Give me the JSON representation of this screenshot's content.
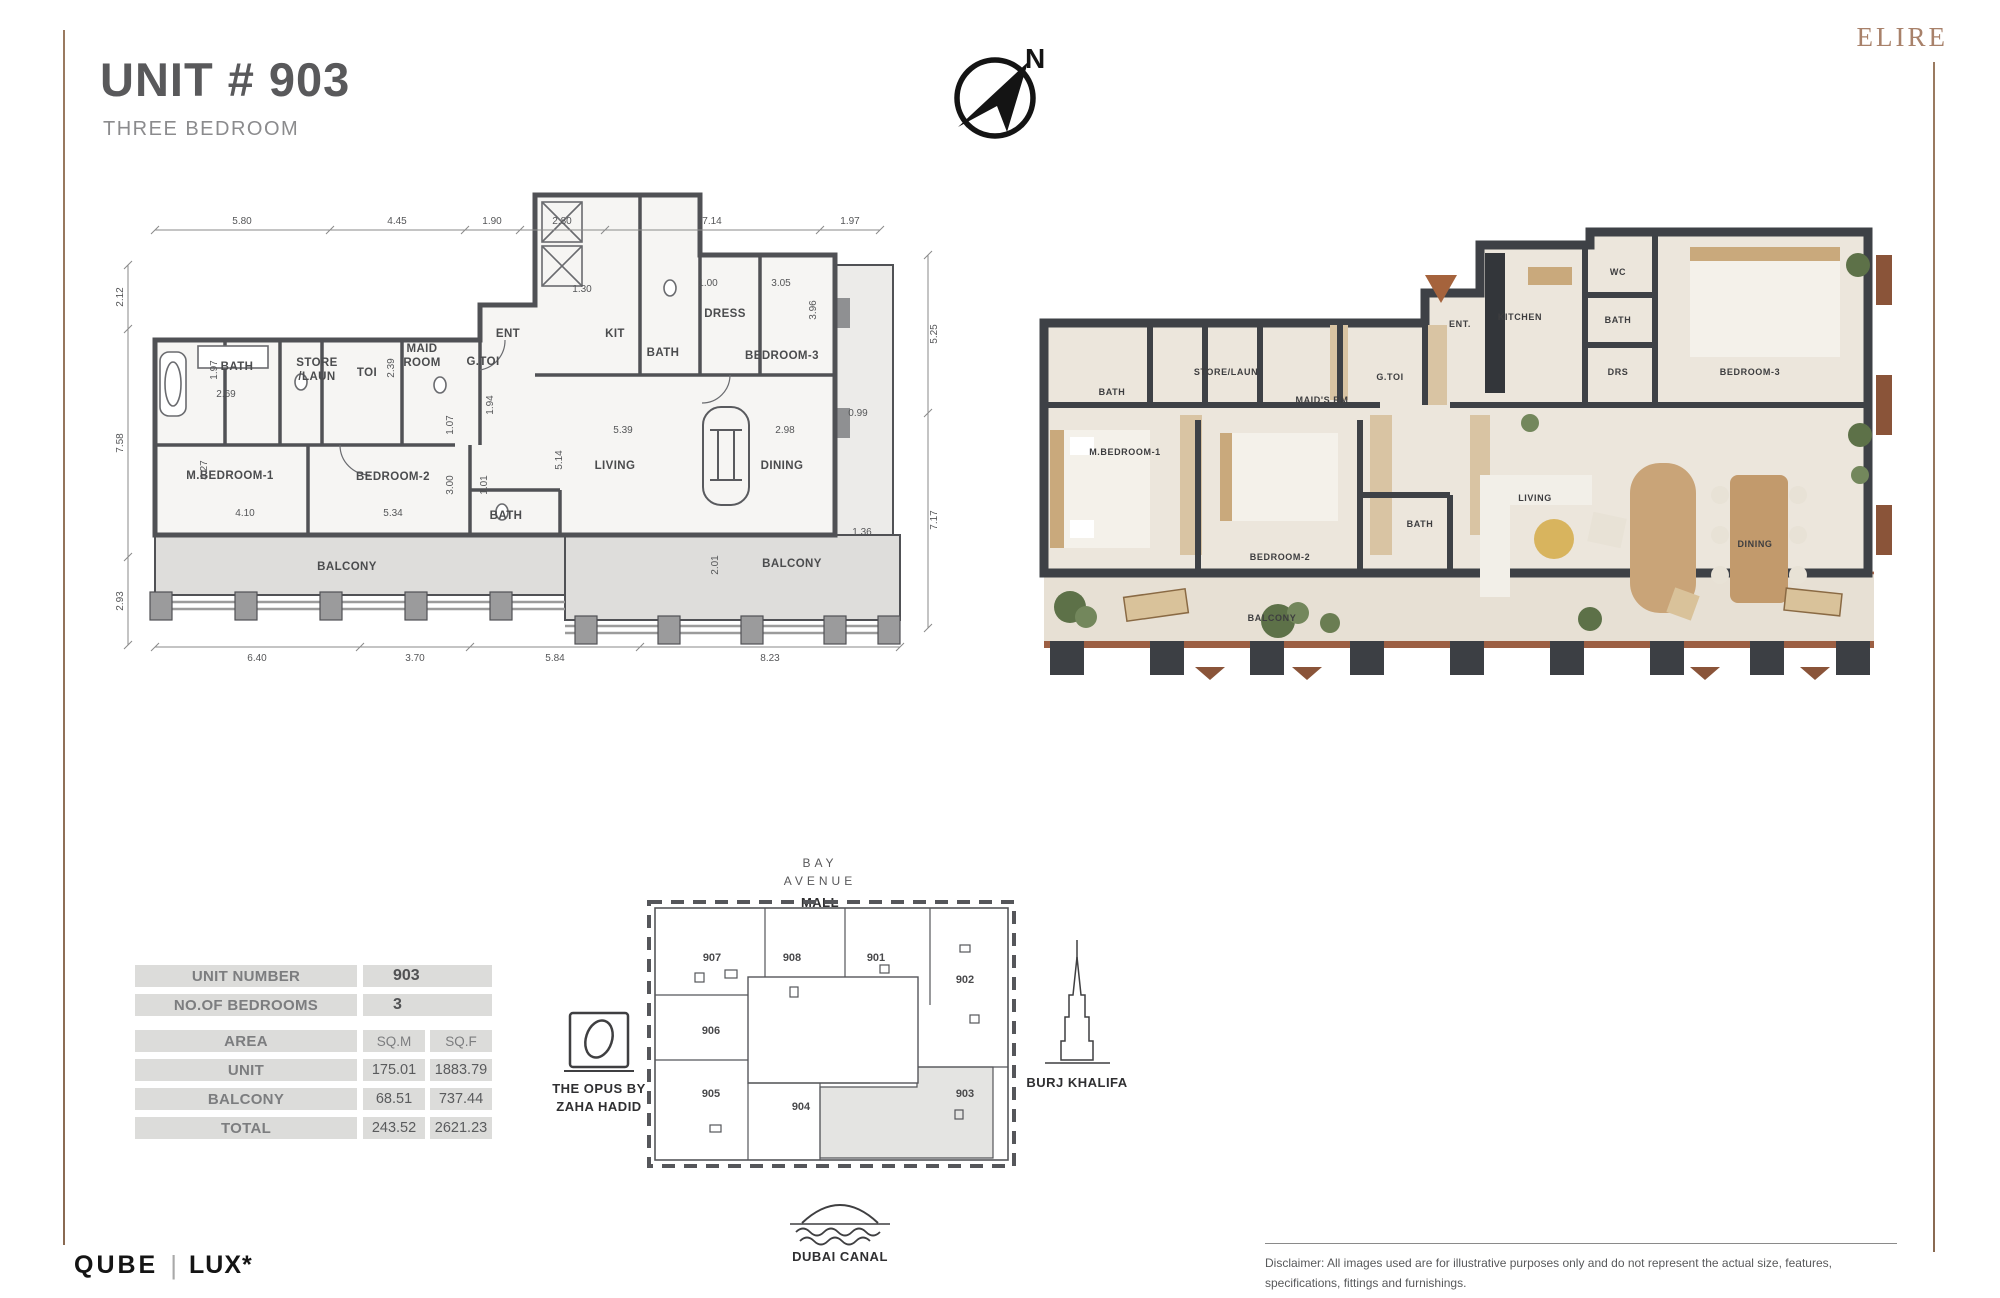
{
  "header": {
    "title": "UNIT # 903",
    "subtitle": "THREE BEDROOM",
    "brand": "ELIRE",
    "compass_n": "N"
  },
  "tech_plan": {
    "dims_top": [
      "5.80",
      "4.45",
      "1.90",
      "2.80",
      "7.14",
      "1.97"
    ],
    "dims_left": [
      "2.12",
      "7.58",
      "2.93"
    ],
    "dims_right": [
      "5.25",
      "7.17"
    ],
    "dims_bottom": [
      "6.40",
      "3.70",
      "5.84",
      "8.23"
    ],
    "rooms": {
      "bath1": "BATH",
      "store": "STORE",
      "laun": "/LAUN",
      "toi": "TOI",
      "maid1": "MAID",
      "maid2": "ROOM",
      "gtoi": "G.TOI",
      "ent": "ENT",
      "kit": "KIT",
      "bath2": "BATH",
      "dress": "DRESS",
      "bedroom3": "BEDROOM-3",
      "mbedroom1": "M.BEDROOM-1",
      "bedroom2": "BEDROOM-2",
      "bath3": "BATH",
      "living": "LIVING",
      "dining": "DINING",
      "balcony1": "BALCONY",
      "balcony2": "BALCONY"
    },
    "inner_dims": {
      "d130": "1.30",
      "d100": "1.00",
      "d305": "3.05",
      "d396": "3.96",
      "d239": "2.39",
      "d197": "1.97",
      "d269": "2.69",
      "d107": "1.07",
      "d194": "1.94",
      "d539": "5.39",
      "d298": "2.98",
      "d099": "0.99",
      "d514": "5.14",
      "d427": "4.27",
      "d410": "4.10",
      "d534": "5.34",
      "d300": "3.00",
      "d101": "1.01",
      "d136": "1.36",
      "d201": "2.01"
    }
  },
  "render_plan": {
    "rooms": {
      "bath1": "BATH",
      "storelaun": "STORE/LAUN",
      "maid": "MAID'S RM",
      "gtoi": "G.TOI",
      "ent": "ENT.",
      "mbedroom1": "M.BEDROOM-1",
      "bedroom2": "BEDROOM-2",
      "bath2": "BATH",
      "kitchen": "KITCHEN",
      "wc": "WC",
      "bath3": "BATH",
      "drs": "DRS",
      "bedroom3": "BEDROOM-3",
      "living": "LIVING",
      "dining": "DINING",
      "balcony": "BALCONY"
    }
  },
  "table": {
    "r1_label": "UNIT NUMBER",
    "r1_value": "903",
    "r2_label": "NO.OF BEDROOMS",
    "r2_value": "3",
    "r3_label": "AREA",
    "r3_c1": "SQ.M",
    "r3_c2": "SQ.F",
    "rows": [
      {
        "label": "UNIT",
        "sqm": "175.01",
        "sqf": "1883.79"
      },
      {
        "label": "BALCONY",
        "sqm": "68.51",
        "sqf": "737.44"
      },
      {
        "label": "TOTAL",
        "sqm": "243.52",
        "sqf": "2621.23"
      }
    ]
  },
  "siteplan": {
    "bay": "BAY",
    "avenue": "AVENUE",
    "mall": "MALL",
    "units": {
      "u907": "907",
      "u908": "908",
      "u901": "901",
      "u902": "902",
      "u906": "906",
      "u905": "905",
      "u904": "904",
      "u903": "903"
    },
    "opus_line1": "THE OPUS BY",
    "opus_line2": "ZAHA HADID",
    "burj": "BURJ KHALIFA",
    "canal": "DUBAI CANAL"
  },
  "footer": {
    "logo_left": "QUBE",
    "logo_right": "LUX*",
    "disclaimer_line1": "Disclaimer: All images used are for illustrative purposes only and do not represent the actual size, features,",
    "disclaimer_line2": "specifications, fittings and furnishings."
  },
  "colors": {
    "accent_brown": "#8f7058",
    "wall_gray": "#505155",
    "balcony_fill": "#dedddb",
    "render_wall": "#3e4146",
    "render_floor": "#ece6dc",
    "terracotta": "#a4644a",
    "table_cell": "#dcdcda",
    "brand_tan": "#a8816a"
  }
}
